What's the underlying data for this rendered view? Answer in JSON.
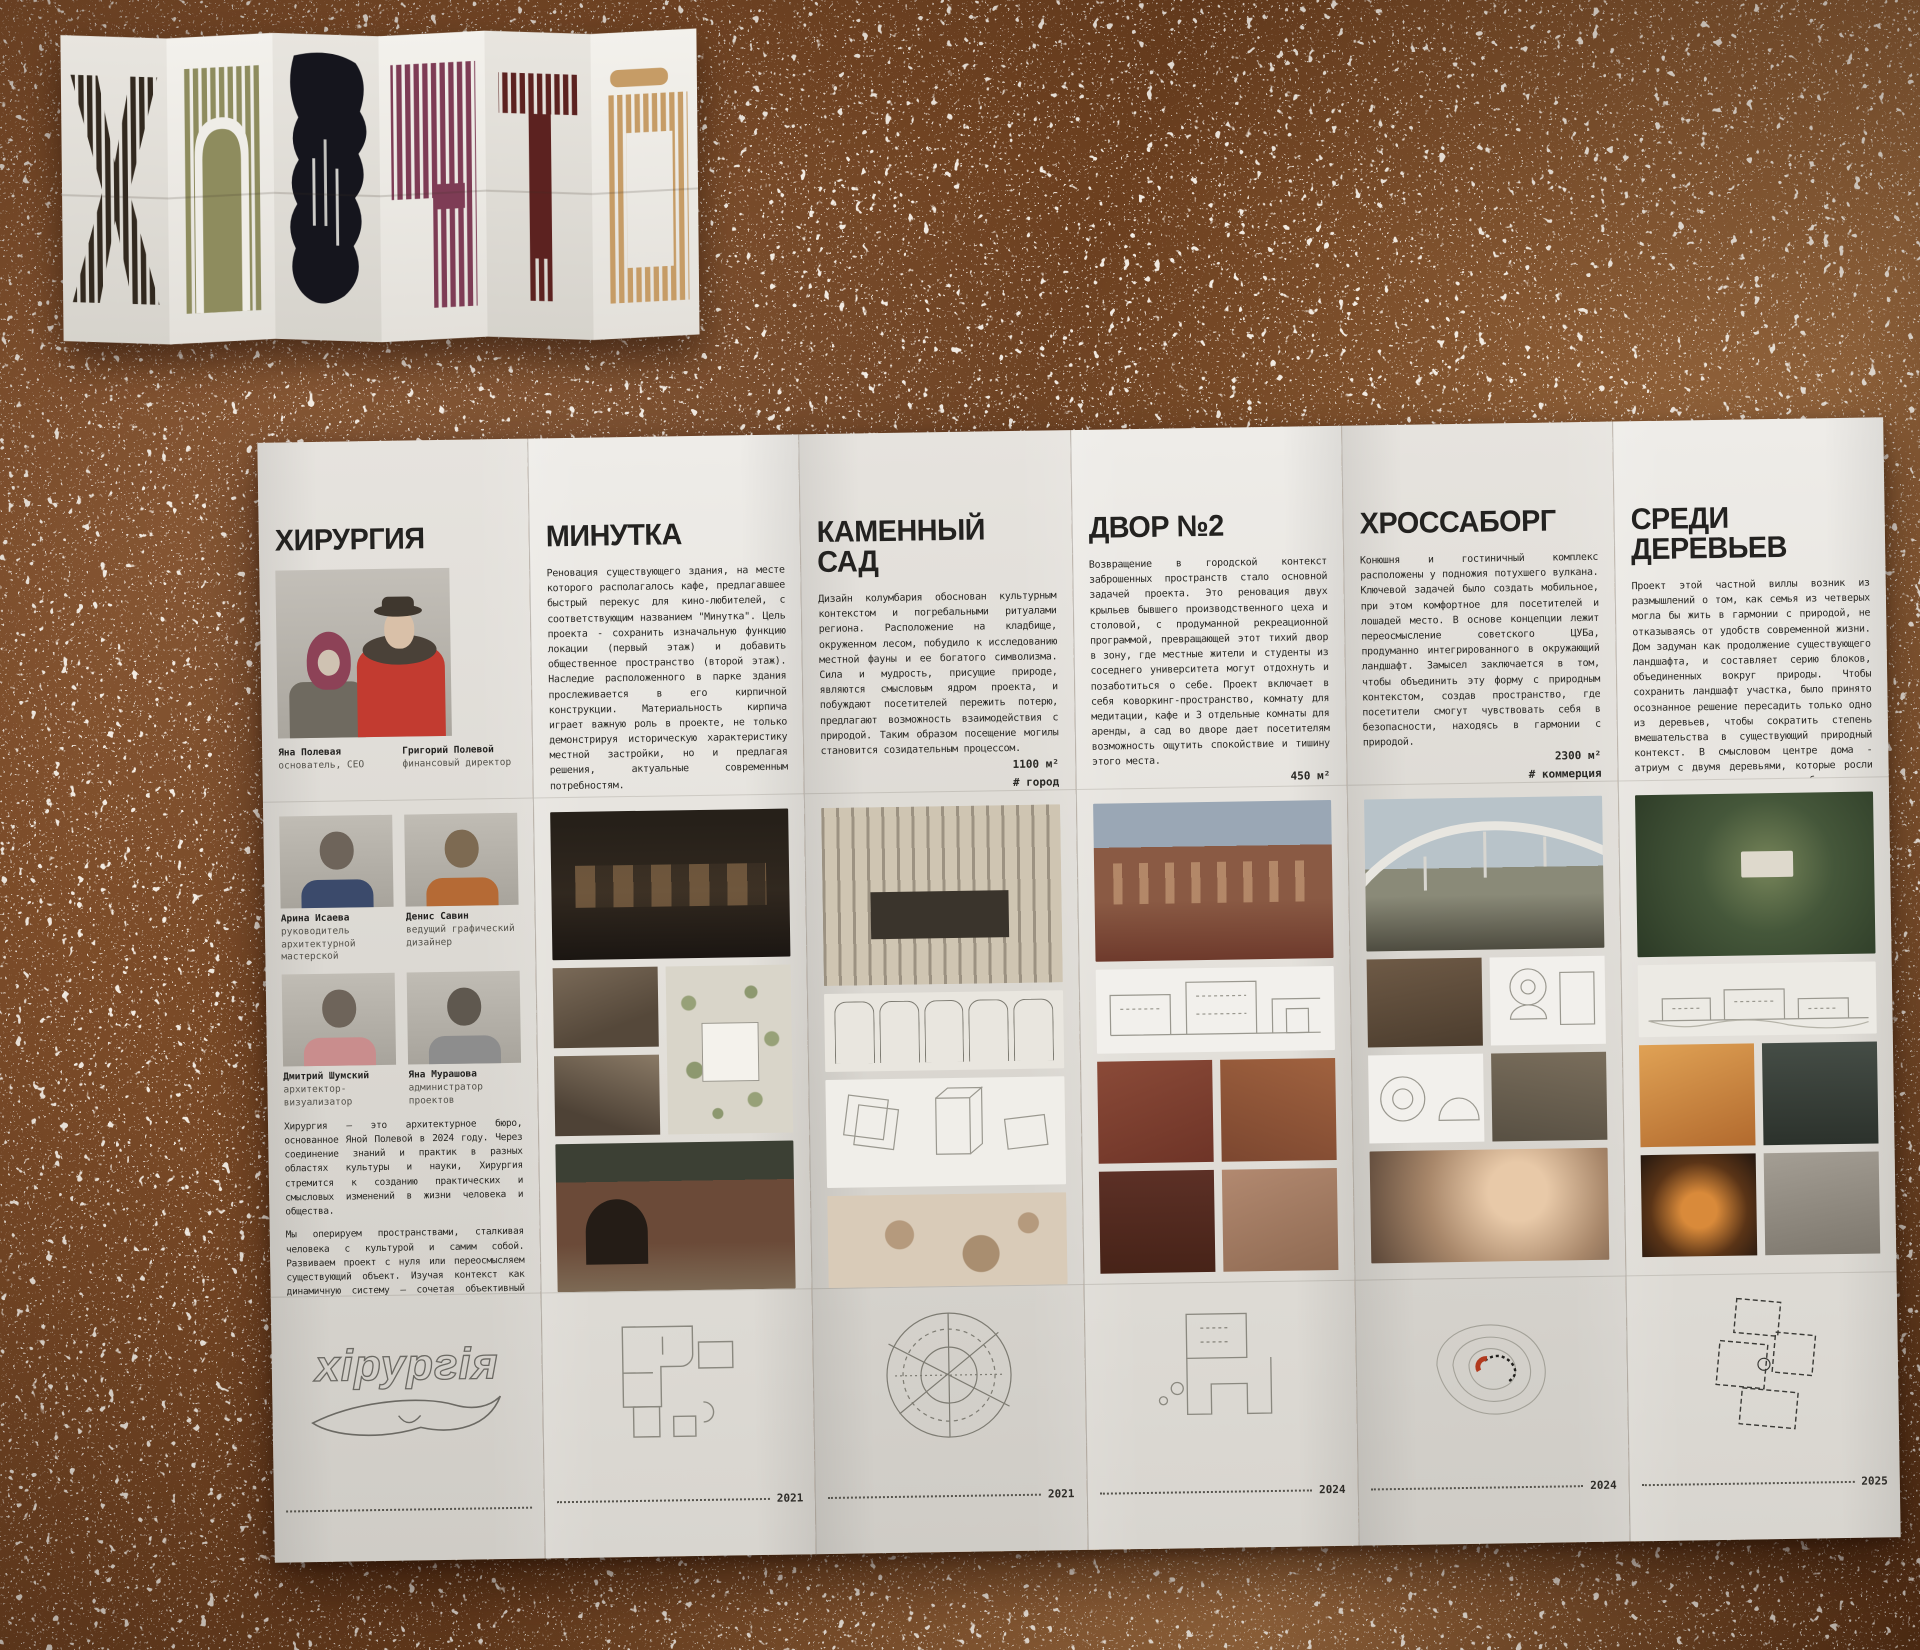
{
  "background": {
    "base_color": "#7c4c28",
    "sparkle_color": "#f4efe6"
  },
  "accordion": {
    "panels": [
      {
        "glyph": "x-letter-print",
        "color": "#32291f"
      },
      {
        "glyph": "arch-letter-print",
        "color": "#8e8c5e"
      },
      {
        "glyph": "ink-blob-print",
        "color": "#15151d"
      },
      {
        "glyph": "step-letter-print",
        "color": "#7e3c55"
      },
      {
        "glyph": "t-letter-print",
        "color": "#5c2220"
      },
      {
        "glyph": "frame-letter-print",
        "color": "#c69c66"
      }
    ]
  },
  "brochure": {
    "panels": [
      {
        "id": "studio",
        "title": "ХИРУРГИЯ",
        "founders": [
          {
            "name": "Яна Полевая",
            "role": "основатель, CEO"
          },
          {
            "name": "Григорий Полевой",
            "role": "финансовый директор"
          }
        ],
        "team": [
          {
            "name": "Арина Исаева",
            "role": "руководитель архитектурной мастерской"
          },
          {
            "name": "Денис Савин",
            "role": "ведущий графический дизайнер"
          },
          {
            "name": "Дмитрий Шумский",
            "role": "архитектор-визуализатор"
          },
          {
            "name": "Яна Мурашова",
            "role": "администратор проектов"
          }
        ],
        "about": [
          "Хирургия — это архитектурное бюро, основанное Яной Полевой в 2024 году. Через соединение знаний и практик в разных областях культуры и науки, Хирургия стремится к созданию практических и смысловых изменений в жизни человека и общества.",
          "Мы оперируем пространствами, сталкивая человека с культурой и самим собой. Развиваем проект с нуля или переосмысляем существующий объект. Изучая контекст как динамичную систему — сочетая объективный анализ с чувственным восприятием, создаём среду, которая запускает изменения",
          "Наше бюро объединяет архитектуру, графический дизайн и консалтинг. Строим цельную логику — от общего замысла к частным решениям. Расчёт точен, воображение безгранично."
        ],
        "logo_text": "хірургія"
      },
      {
        "id": "minutka",
        "title": "МИНУТКА",
        "body": "Реновация существующего здания, на месте которого располагалось кафе, предлагавшее быстрый перекус для кино-любителей, с соответствующим названием \"Минутка\". Цель проекта - сохранить изначальную функцию локации (первый этаж) и добавить общественное пространство (второй этаж). Наследие расположенного в парке здания прослеживается в его кирпичной конструкции. Материальность кирпича играет важную роль в проекте, не только демонстрируя историческую характеристику местной застройки, но и предлагая решения, актуальные современным потребностям.",
        "area": "300 м²",
        "tag": "# город",
        "year": "2021"
      },
      {
        "id": "stone-garden",
        "title": "КАМЕННЫЙ САД",
        "body": "Дизайн колумбария обоснован культурным контекстом и погребальными ритуалами региона. Расположение на кладбище, окруженном лесом, побудило к исследованию местной фауны и ее богатого символизма. Сила и мудрость, присущие природе, являются смысловым ядром проекта, и побуждают посетителей пережить потерю, предлагают возможность взаимодействия с природой. Таким образом посещение могилы становится созидательным процессом.",
        "area": "1100 м²",
        "tag": "# город",
        "year": "2021"
      },
      {
        "id": "yard-2",
        "title": "ДВОР №2",
        "body": "Возвращение в городской контекст заброшенных пространств стало основной задачей проекта. Это реновация двух крыльев бывшего производственного цеха и столовой, с продуманной рекреационной программой, превращающей этот тихий двор в зону, где местные жители и студенты из соседнего университета могут отдохнуть и позаботиться о себе. Проект включает в себя коворкинг-пространство, комнату для медитации, кафе и 3 отдельные комнаты для аренды, а сад во дворе дает посетителям возможность ощутить спокойствие и тишину этого места.",
        "area": "450 м²",
        "tag": "# коммерция",
        "year": "2024"
      },
      {
        "id": "hrossaborg",
        "title": "ХРОССАБОРГ",
        "body": "Конюшня и гостиничный комплекс расположены у подножия потухшего вулкана. Ключевой задачей было создать мобильное, при этом комфортное для посетителей и лошадей место. В основе концепции лежит переосмысление советского ЦУБа, продуманно интегрированного в окружающий ландшафт. Замысел заключается в том, чтобы объединить эту форму с природным контекстом, создав пространство, где посетители смогут чувствовать себя в безопасности, находясь в гармонии с природой.",
        "area": "2300 м²",
        "tag": "# коммерция",
        "year": "2024"
      },
      {
        "id": "among-trees",
        "title": "СРЕДИ ДЕРЕВЬЕВ",
        "body": "Проект этой частной виллы возник из размышлений о том, как семья из четверых могла бы жить в гармонии с природой, не отказываясь от удобств современной жизни. Дом задуман как продолжение существующего ландшафта, и составляет серию блоков, объединенных вокруг природы. Чтобы сохранить ландшафт участка, было принято осознанное решение пересадить только одно из деревьев, чтобы сократить степень вмешательства в существующий природный контекст. В смысловом центре дома - атриум с двумя деревьями, которые росли на этом месте задолго до разработки этого проекта.",
        "area": "700 м²",
        "tag": "# жилое",
        "year": "2025"
      }
    ]
  }
}
